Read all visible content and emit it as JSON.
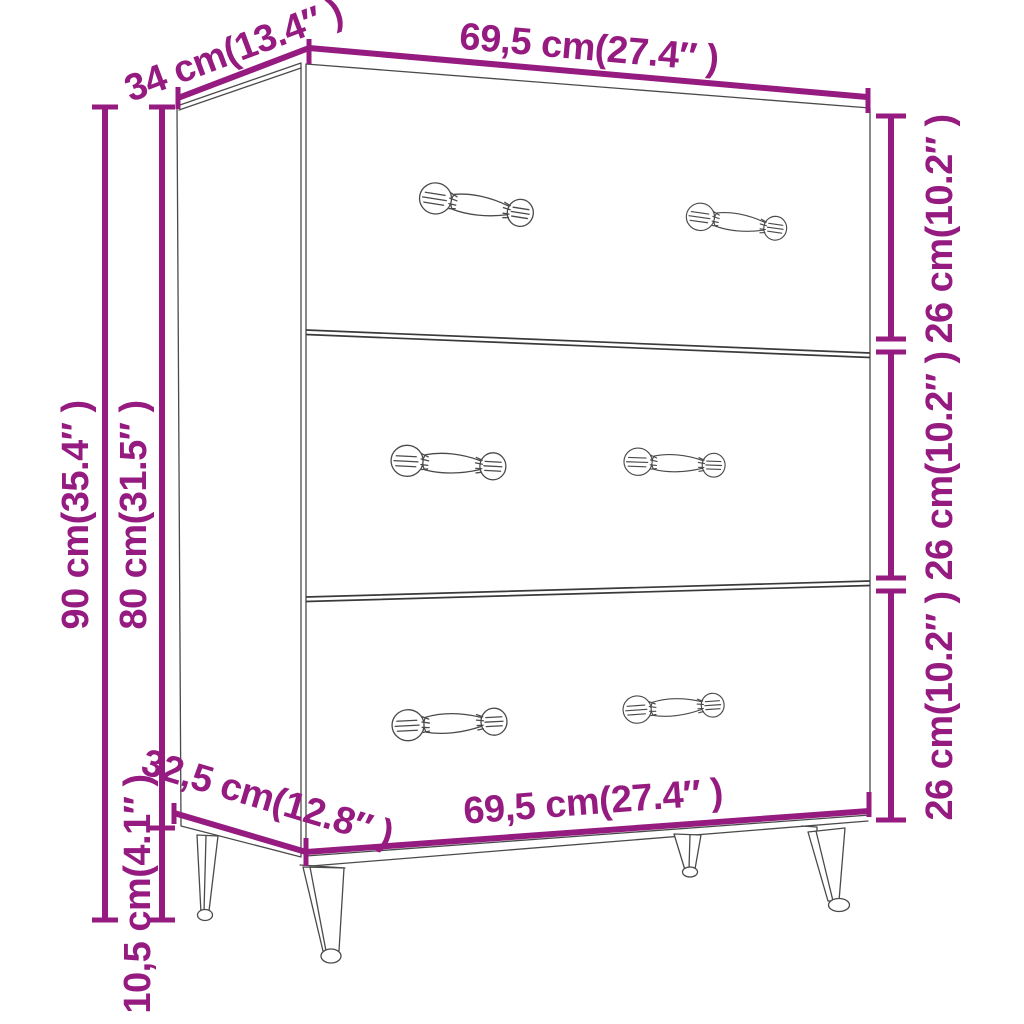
{
  "title": "Sideboard with 3 drawers — dimension diagram",
  "colors": {
    "dimension": "#951B81",
    "linework": "#4A4A4A",
    "divider": "#3A3A3A",
    "background": "#FFFFFF"
  },
  "labels": {
    "top_depth": "34 cm(13.4″ )",
    "top_width": "69,5 cm(27.4″ )",
    "drawer1_height": "26 cm(10.2″ )",
    "drawer2_height": "26 cm(10.2″ )",
    "drawer3_height": "26 cm(10.2″ )",
    "overall_height": "90 cm(35.4″ )",
    "body_height": "80 cm(31.5″ )",
    "leg_height": "10,5 cm(4.1″ )",
    "base_depth": "32,5 cm(12.8″ )",
    "base_width": "69,5 cm(27.4″ )"
  }
}
